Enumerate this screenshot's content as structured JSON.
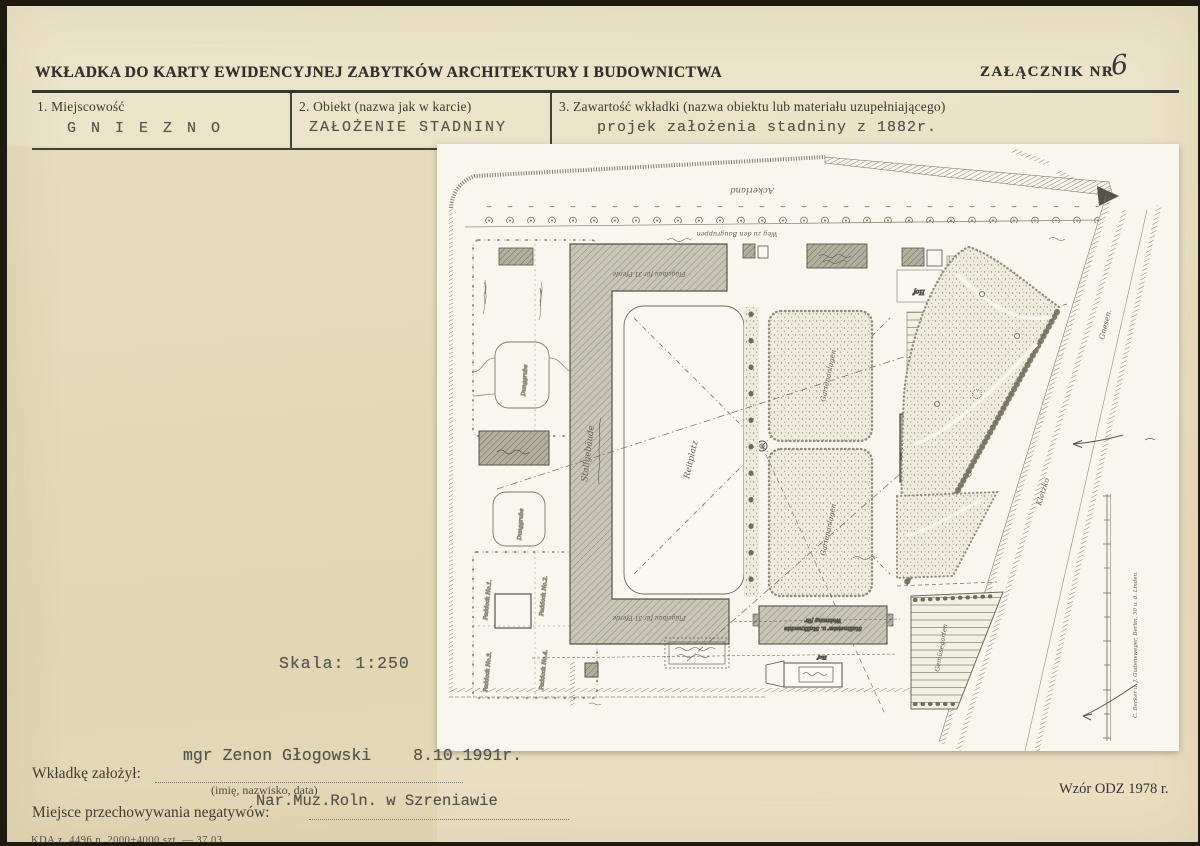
{
  "header": {
    "title": "WKŁADKA DO KARTY EWIDENCYJNEJ ZABYTKÓW ARCHITEKTURY I BUDOWNICTWA",
    "attachment_label": "ZAŁĄCZNIK NR",
    "attachment_number": "6"
  },
  "fields": [
    {
      "label": "1. Miejscowość",
      "value": "G N I E Z N O"
    },
    {
      "label": "2. Obiekt (nazwa jak w karcie)",
      "value": "ZAŁOŻENIE STADNINY"
    },
    {
      "label": "3. Zawartość wkładki (nazwa obiektu lub materiału uzupełniającego)",
      "value": "projek założenia stadniny z 1882r."
    }
  ],
  "plan": {
    "scale_note": "Skala: 1:250",
    "labels": {
      "ackerland": "Ackerland",
      "weg": "Weg zu den Baugruppen",
      "reitplatz": "Reitplatz",
      "stall": "Stallgebäude",
      "fluegelbau": "Flügelbau für 31 Pferde",
      "garden": "Gartenanlagen",
      "gemuesegarten": "Gemüsegarten",
      "hof": "Hof",
      "paddock1": "Paddock No.1.",
      "paddock2": "Paddock No.2.",
      "paddock3": "Paddock No.3.",
      "paddock4": "Paddock No.4.",
      "dunggrube": "Dunggrube",
      "wohnhaus_l1": "Wohnhaus des",
      "wohnhaus_l2": "Gestütswärters",
      "wohnung_l1": "Wohnung für",
      "wohnung_l2": "Stallmeister u. Stallknechte",
      "gnesen": "Gnesen.",
      "kletzko": "Kletzko",
      "credit": "C. Becker u. J. Gudensweger, Berlin, 30 u. d. Linden."
    }
  },
  "footer": {
    "founder_label": "Wkładkę założył:",
    "founder_hint": "(imię, nazwisko, data)",
    "founder_name": "mgr Zenon Głogowski",
    "founder_date": "8.10.1991r.",
    "negatives_label": "Miejsce przechowywania negatywów:",
    "negatives_value": "Nar.Muz.Roln. w Szreniawie",
    "print_code": "KDA z. 4496 n. 2000+4000 szt. — 37.03",
    "form_code": "Wzór ODZ 1978 r."
  }
}
